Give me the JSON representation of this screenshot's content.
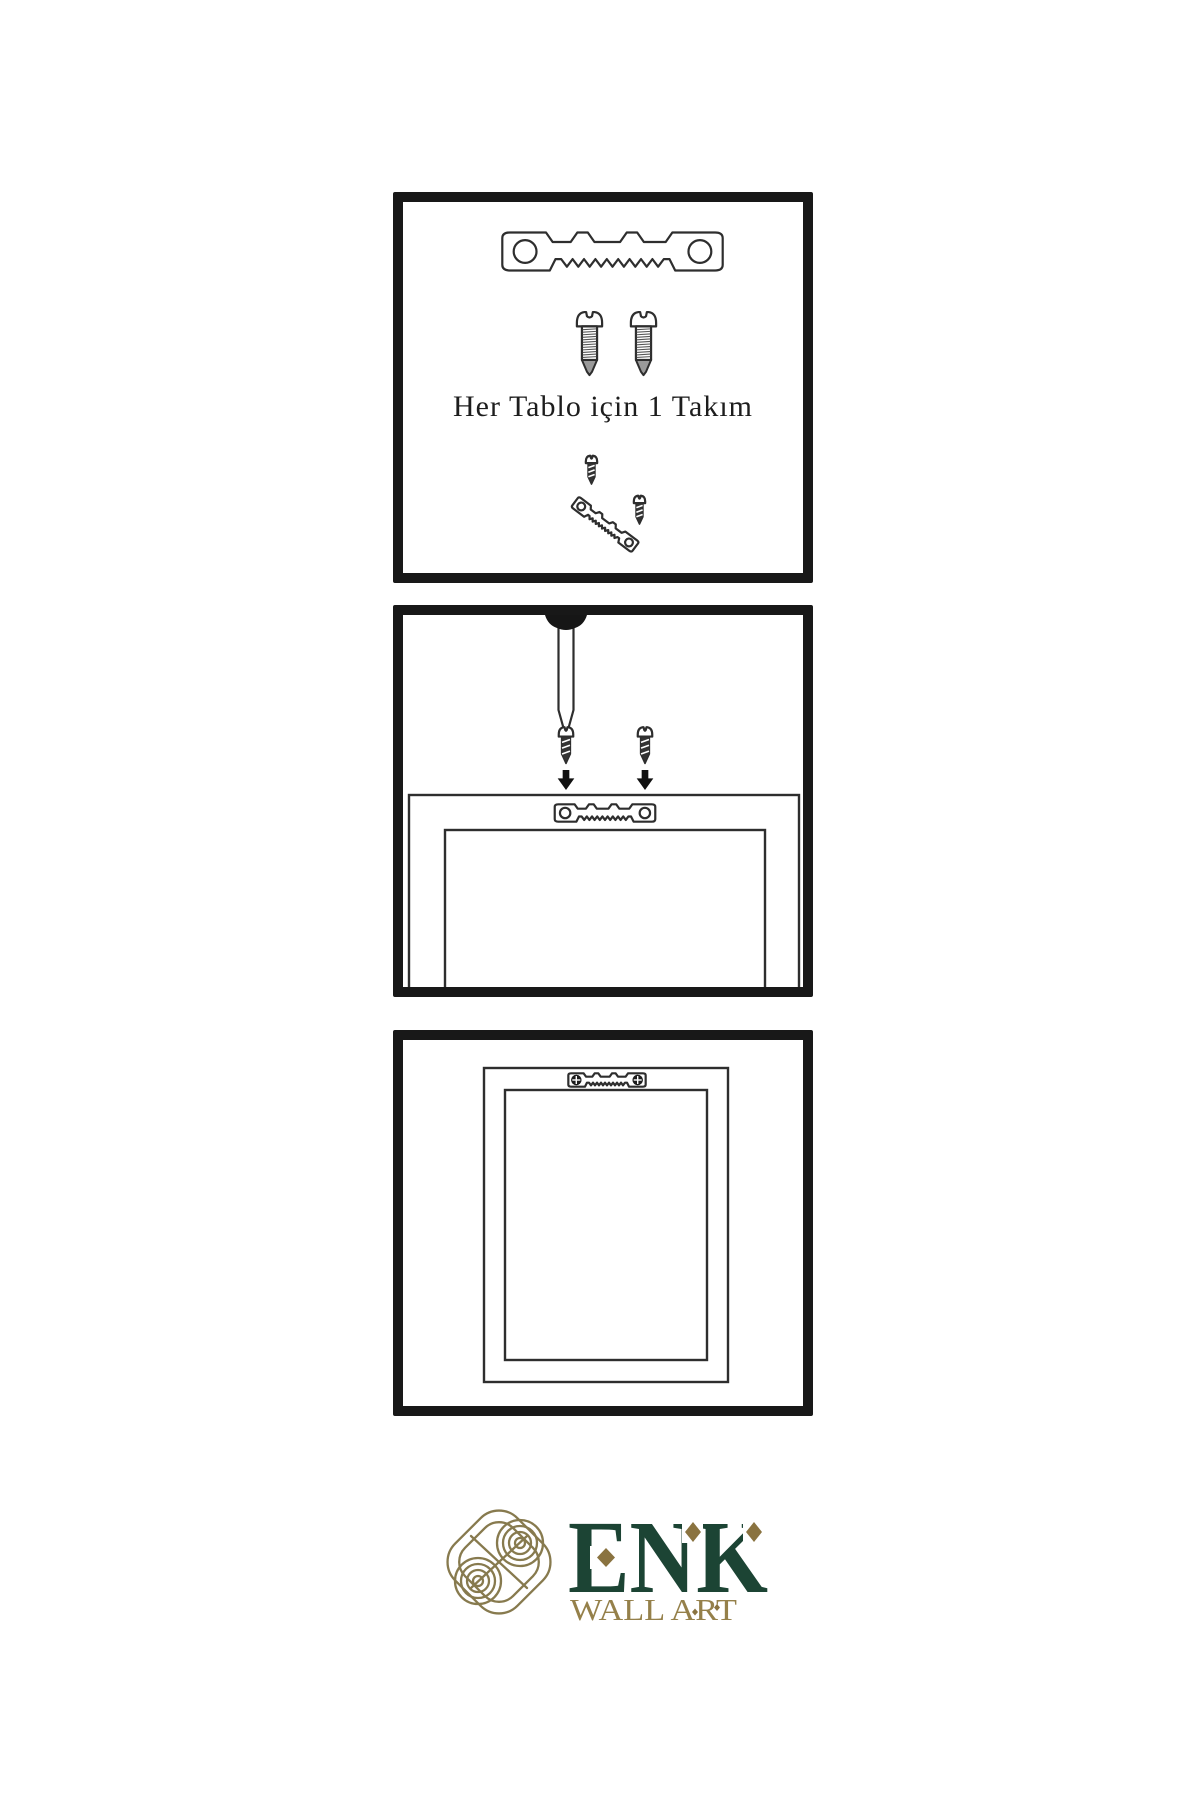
{
  "colors": {
    "ink": "#2e2e2e",
    "panel-border": "#181818",
    "metal-dark": "#333333",
    "green": "#1c4434",
    "gold": "#95804a",
    "knot": "#877a4e",
    "diamond": "#8a7340"
  },
  "instructions": {
    "step1_caption": "Her Tablo için 1 Takım"
  },
  "brand": {
    "name": "ENK",
    "subtitle": "WALL ART"
  }
}
